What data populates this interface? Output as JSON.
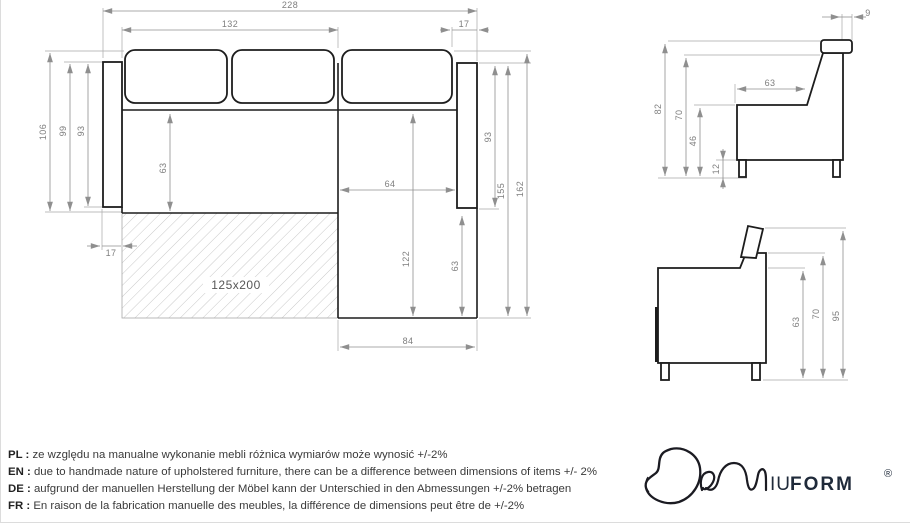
{
  "plan": {
    "dim_total_width": "228",
    "dim_seat_width": "132",
    "dim_armrest_width": "17",
    "dim_depth_total": "106",
    "dim_depth_99": "99",
    "dim_depth_93": "93",
    "dim_seat_depth": "63",
    "dim_chaise_inner_width": "64",
    "dim_left_offset": "17",
    "bed_size_label": "125x200",
    "dim_chaise_length": "122",
    "dim_chaise_front_ext": "63",
    "dim_chaise_width": "84",
    "dim_right_93": "93",
    "dim_right_155": "155",
    "dim_right_162": "162"
  },
  "side_back": {
    "dim_headrest_depth": "9",
    "dim_height_total": "82",
    "dim_height_back": "70",
    "dim_seat_height": "46",
    "dim_leg_height": "12",
    "dim_seat_depth": "63"
  },
  "side_arm": {
    "dim_height_63": "63",
    "dim_height_70": "70",
    "dim_height_95": "95"
  },
  "disclaimer": {
    "separator": " : ",
    "rows": [
      {
        "lang": "PL",
        "text": "ze względu na manualne wykonanie mebli różnica wymiarów może wynosić +/-2%"
      },
      {
        "lang": "EN",
        "text": "due to handmade nature of upholstered furniture, there can be a difference between dimensions of items +/- 2%"
      },
      {
        "lang": "DE",
        "text": "aufgrund der manuellen Herstellung der Möbel kann der Unterschied in den Abmessungen +/-2% betragen"
      },
      {
        "lang": "FR",
        "text": "En raison de la fabrication manuelle des meubles, la différence de dimensions peut être de +/-2%"
      }
    ]
  },
  "logo": {
    "letters_iu": "IU",
    "letters_form": "FORM",
    "registered": "®"
  }
}
